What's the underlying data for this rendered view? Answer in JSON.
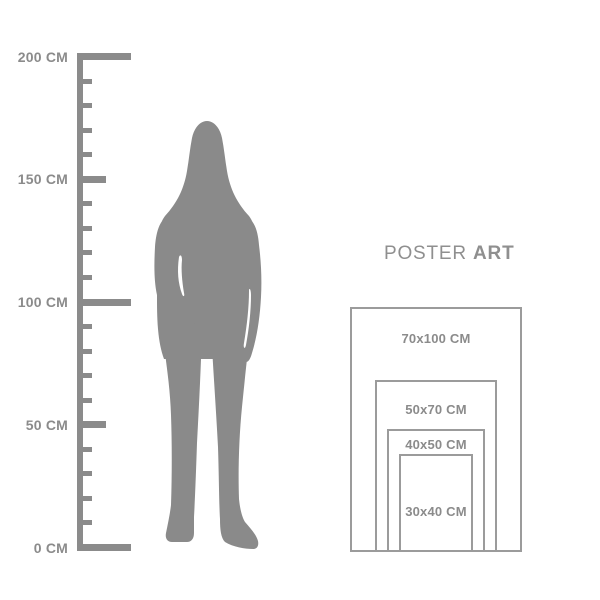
{
  "colors": {
    "ruler_gray": "#8b8b8b",
    "figure_gray": "#8a8a8a",
    "rect_border_gray": "#9b9b9b",
    "text_gray": "#8b8b8b",
    "background": "#ffffff"
  },
  "ruler": {
    "unit": "CM",
    "min_cm": 0,
    "max_cm": 200,
    "minor_step_cm": 10,
    "labeled_step_cm": 50,
    "labels": [
      {
        "cm": 200,
        "text": "200 CM"
      },
      {
        "cm": 150,
        "text": "150 CM"
      },
      {
        "cm": 100,
        "text": "100 CM"
      },
      {
        "cm": 50,
        "text": "50 CM"
      },
      {
        "cm": 0,
        "text": "0 CM"
      }
    ]
  },
  "figure": {
    "icon": "woman-silhouette"
  },
  "poster_chart": {
    "title": {
      "regular": "POSTER",
      "bold": "ART"
    },
    "sizes": [
      {
        "label": "70x100 CM",
        "width_cm": 70,
        "height_cm": 100
      },
      {
        "label": "50x70 CM",
        "width_cm": 50,
        "height_cm": 70
      },
      {
        "label": "40x50 CM",
        "width_cm": 40,
        "height_cm": 50
      },
      {
        "label": "30x40 CM",
        "width_cm": 30,
        "height_cm": 40
      }
    ]
  }
}
